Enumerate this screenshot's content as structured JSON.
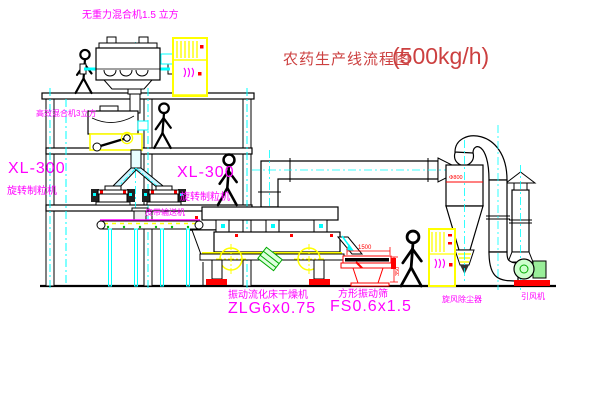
{
  "title": {
    "text": "农药生产线流程图",
    "capacity": "(500kg/h)"
  },
  "labels": {
    "gravity_mixer": "无重力混合机1.5 立方",
    "high_eff_mixer": "高效混合机3立方",
    "granulator_left_model": "XL-300",
    "granulator_left_name": "旋转制粒机",
    "granulator_right_model": "XL-300",
    "granulator_right_name": "旋转制粒机",
    "belt_conveyor": "皮带输送机",
    "dryer_name": "振动流化床干燥机",
    "dryer_model": "ZLG6x0.75",
    "screen_name": "方形振动筛",
    "screen_model": "FS0.6x1.5",
    "cyclone": "旋风除尘器",
    "fan": "引风机"
  },
  "dimensions": {
    "screen_length": "1500",
    "screen_height": "350",
    "cyclone_diameter": "Φ800"
  },
  "colors": {
    "label_magenta": "#ff00ff",
    "title_red": "#cc4040",
    "dimension_red": "#ff0000",
    "line_black": "#000000",
    "accent_yellow": "#ffff00",
    "accent_cyan": "#00ffff",
    "accent_green": "#00aa00",
    "background": "#ffffff"
  }
}
